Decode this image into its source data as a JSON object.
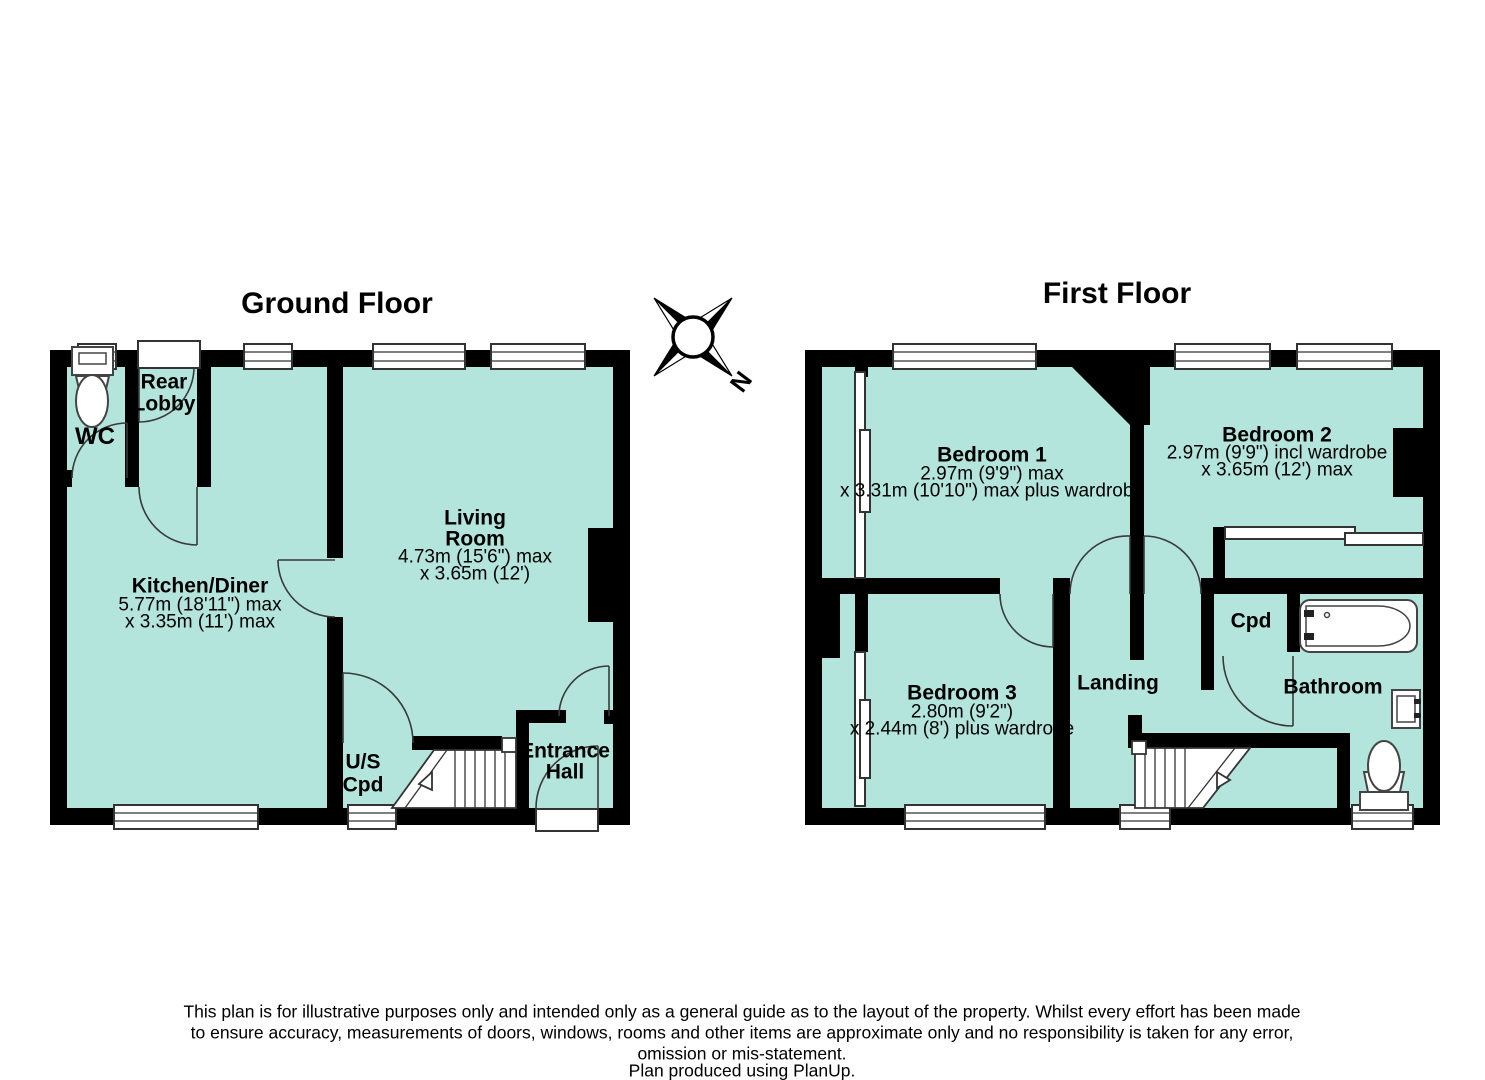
{
  "colors": {
    "room_fill": "#b3e5dc",
    "wall": "#000000"
  },
  "ground_floor": {
    "title": "Ground Floor",
    "rooms": {
      "wc": {
        "name": "WC"
      },
      "rear_lobby": {
        "line1": "Rear",
        "line2": "Lobby"
      },
      "kitchen_diner": {
        "name": "Kitchen/Diner",
        "dim1": "5.77m (18'11\") max",
        "dim2": "x 3.35m (11') max"
      },
      "living_room": {
        "line1": "Living",
        "line2": "Room",
        "dim1": "4.73m (15'6\") max",
        "dim2": "x 3.65m (12')"
      },
      "us_cpd": {
        "line1": "U/S",
        "line2": "Cpd"
      },
      "entrance_hall": {
        "line1": "Entrance",
        "line2": "Hall"
      }
    }
  },
  "first_floor": {
    "title": "First Floor",
    "rooms": {
      "bedroom_1": {
        "name": "Bedroom 1",
        "dim1": "2.97m (9'9\") max",
        "dim2": "x 3.31m (10'10\") max plus wardrobe"
      },
      "bedroom_2": {
        "name": "Bedroom 2",
        "dim1": "2.97m (9'9\") incl wardrobe",
        "dim2": "x 3.65m (12') max"
      },
      "bedroom_3": {
        "name": "Bedroom 3",
        "dim1": "2.80m (9'2\")",
        "dim2": "x 2.44m (8') plus wardrobe"
      },
      "landing": {
        "name": "Landing"
      },
      "cpd": {
        "name": "Cpd"
      },
      "bathroom": {
        "name": "Bathroom"
      }
    }
  },
  "compass": {
    "north_label": "N"
  },
  "footer": {
    "line1": "This plan is for illustrative purposes only and intended only as a general guide as to the layout of the property. Whilst every effort has been made",
    "line2": "to ensure accuracy, measurements of doors, windows, rooms and other items are approximate only and no responsibility is taken for any error,",
    "line3": "omission or mis-statement.",
    "line4": "Plan produced using PlanUp."
  }
}
